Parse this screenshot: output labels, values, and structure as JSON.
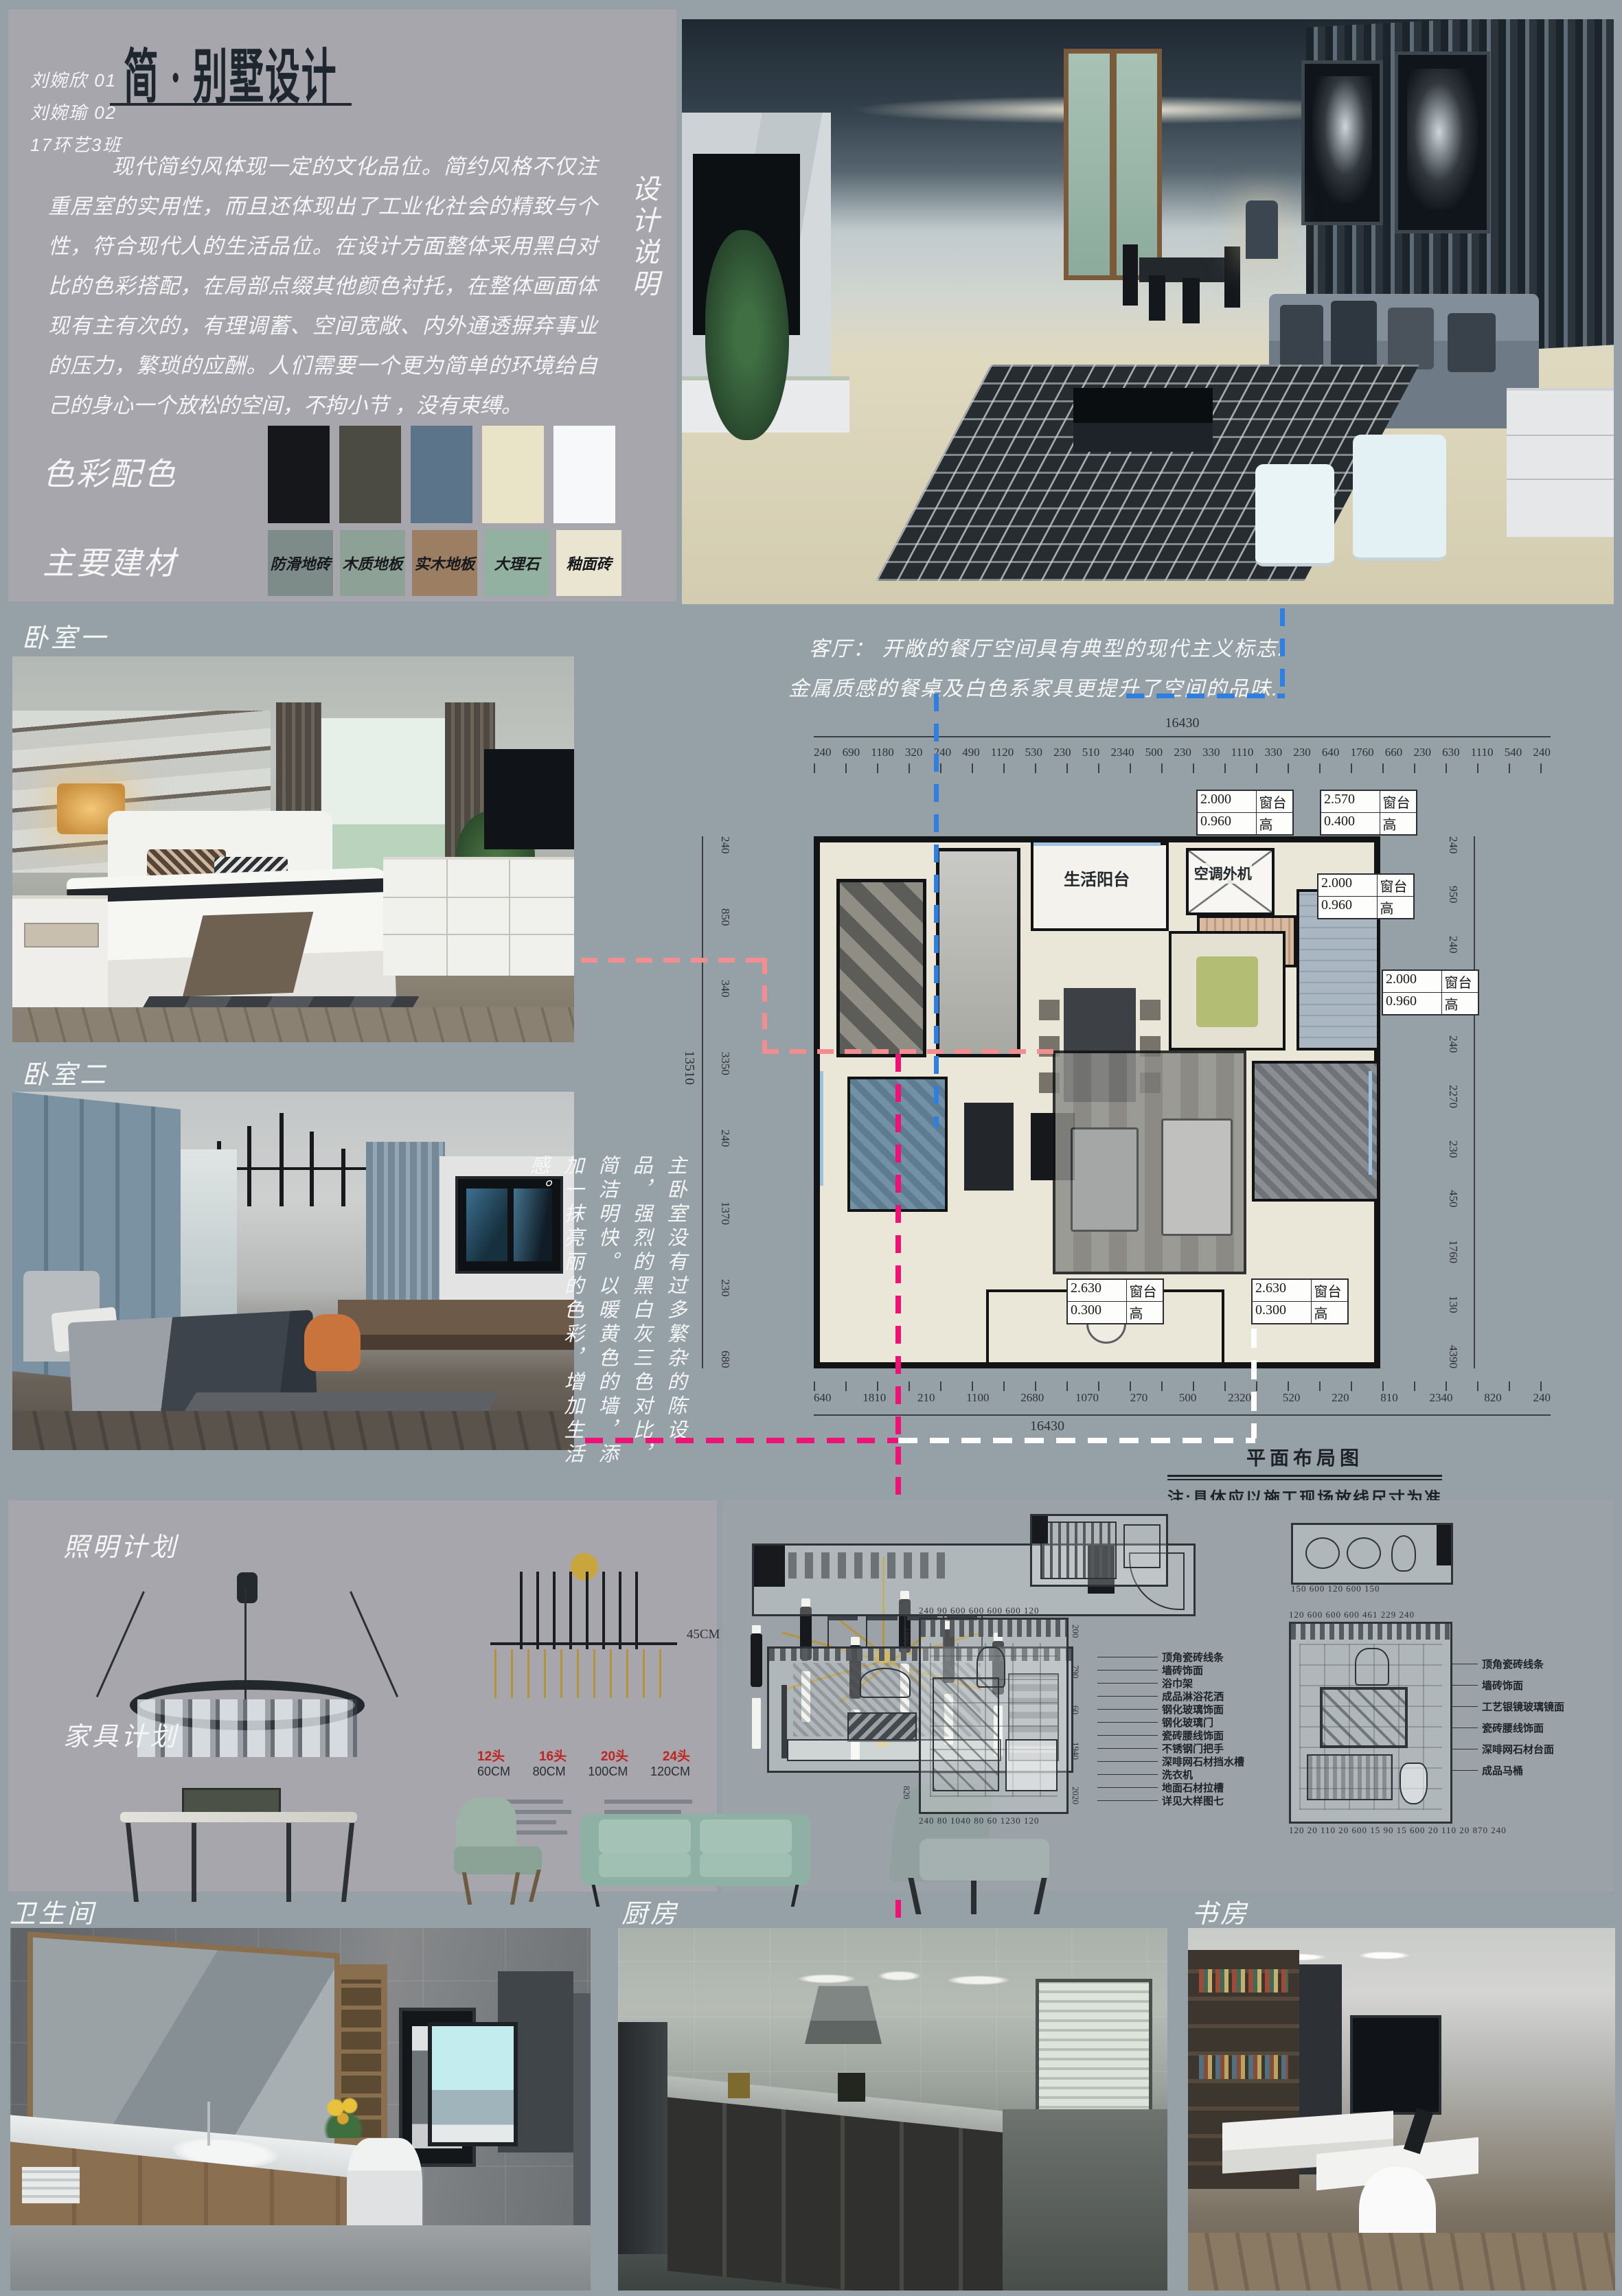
{
  "header": {
    "authors": [
      "刘婉欣   01",
      "刘婉瑜   02",
      "17环艺3班"
    ],
    "title": "简 · 别墅设计",
    "vertical_label": "设计说明",
    "description": "现代简约风体现一定的文化品位。简约风格不仅注重居室的实用性，而且还体现出了工业化社会的精致与个性，符合现代人的生活品位。在设计方面整体采用黑白对比的色彩搭配，在局部点缀其他颜色衬托，在整体画面体现有主有次的，有理调蓄、空间宽敞、内外通透摒弃事业的压力，繁琐的应酬。人们需要一个更为简单的环境给自己的身心一个放松的空间，不拘小节 ，没有束缚。"
  },
  "palette": {
    "label": "色彩配色",
    "colors": [
      "#15171b",
      "#4b4b43",
      "#5b7489",
      "#e9e4c8",
      "#f7f8f9"
    ]
  },
  "materials": {
    "label": "主要建材",
    "items": [
      {
        "name": "防滑地砖",
        "color": "#7d8c89"
      },
      {
        "name": "木质地板",
        "color": "#8da196"
      },
      {
        "name": "实木地板",
        "color": "#9c7e63"
      },
      {
        "name": "大理石",
        "color": "#92b1a1"
      },
      {
        "name": "釉面砖",
        "color": "#eae5d0"
      }
    ]
  },
  "living_caption": {
    "line1": "客厅：  开敞的餐厅空间具有典型的现代主义标志.",
    "line2": "金属质感的餐桌及白色系家具更提升了空间的品味."
  },
  "section_labels": {
    "bedroom1": "卧室一",
    "bedroom2": "卧室二",
    "lighting": "照明计划",
    "furniture": "家具计划",
    "bathroom": "卫生间",
    "kitchen": "厨房",
    "study": "书房"
  },
  "bedroom_note": "主卧室没有过多繁杂的陈设品，强烈的黑白灰三色对比，简洁明快。以暖黄色的墙，添加一抹亮丽的色彩，增加生活感。",
  "plan": {
    "room_labels": {
      "balcony": "生活阳台",
      "ac_unit": "空调外机"
    },
    "dims": {
      "total_w": "16430",
      "total_h": "13510",
      "top": [
        "240",
        "690",
        "1180",
        "320",
        "240",
        "490",
        "1120",
        "530",
        "230",
        "510",
        "2340",
        "500",
        "230",
        "330",
        "1110",
        "330",
        "230",
        "640",
        "1760",
        "660",
        "230",
        "630",
        "1110",
        "540",
        "240"
      ],
      "bottom": [
        "640",
        "1810",
        "210",
        "1100",
        "2680",
        "1070",
        "270",
        "500",
        "2320",
        "520",
        "220",
        "810",
        "2340",
        "820",
        "240"
      ],
      "left": [
        "240",
        "850",
        "340",
        "3350",
        "240",
        "1370",
        "230",
        "680"
      ],
      "right": [
        "240",
        "950",
        "240",
        "350",
        "240",
        "2270",
        "230",
        "450",
        "1760",
        "130",
        "4390"
      ]
    },
    "callouts": [
      {
        "v1": "2.000",
        "u1": "窗台",
        "v2": "0.960",
        "u2": "高"
      },
      {
        "v1": "2.570",
        "u1": "窗台",
        "v2": "0.400",
        "u2": "高"
      },
      {
        "v1": "2.000",
        "u1": "窗台",
        "v2": "0.960",
        "u2": "高"
      },
      {
        "v1": "2.000",
        "u1": "窗台",
        "v2": "0.960",
        "u2": "高"
      },
      {
        "v1": "2.630",
        "u1": "窗台",
        "v2": "0.300",
        "u2": "高"
      },
      {
        "v1": "2.630",
        "u1": "窗台",
        "v2": "0.300",
        "u2": "高"
      }
    ],
    "caption": "平面布局图",
    "note": "注:具体应以施工现场放线尺寸为准"
  },
  "lighting_plan": {
    "height_note": "45CM",
    "heads": [
      "12头",
      "16头",
      "20头",
      "24头"
    ],
    "cms": [
      "60CM",
      "80CM",
      "100CM",
      "120CM"
    ],
    "head_color": "#c02420"
  },
  "elevations": {
    "b_top_dims": "240 90  600  600  600  600  120",
    "b_bottom_dims": "240 80  1040  80 60  1230  120",
    "b_left_dims": [
      "1890",
      "820"
    ],
    "b_right_dims": [
      "200",
      "790",
      "60",
      "1940",
      "2020"
    ],
    "c_plan_dims": "150   600   120   600   150",
    "c_top_dims": "120   600   600   600   461   229  240",
    "c_bottom_dims": "120 20 110 20 600 15 90 15 600 20 110 20  870  240",
    "b_labels": [
      "顶角瓷砖线条",
      "墙砖饰面",
      "浴巾架",
      "成品淋浴花洒",
      "钢化玻璃饰面",
      "钢化玻璃门",
      "瓷砖腰线饰面",
      "不锈钢门把手",
      "深啡网石材挡水槽",
      "洗衣机",
      "地面石材拉槽",
      "详见大样图七"
    ],
    "c_labels": [
      "顶角瓷砖线条",
      "墙砖饰面",
      "工艺银镜玻璃镜面",
      "瓷砖腰线饰面",
      "深啡网石材台面",
      "成品马桶"
    ]
  },
  "connector_colors": {
    "blue": "#2f7fe0",
    "salmon": "#f28d90",
    "magenta": "#ee1277",
    "white": "#ffffff"
  }
}
